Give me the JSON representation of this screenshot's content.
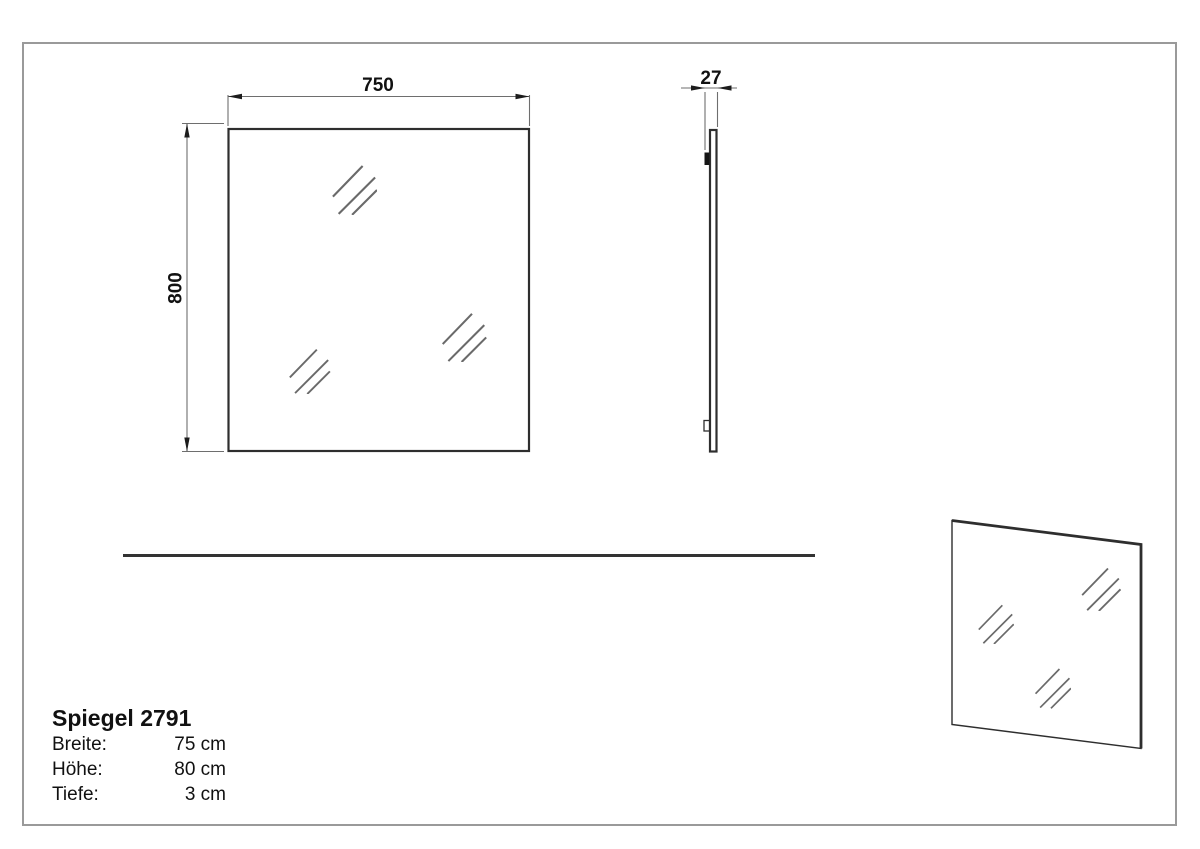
{
  "product": {
    "title": "Spiegel 2791",
    "specs": [
      {
        "label": "Breite:",
        "value": "75 cm"
      },
      {
        "label": "Höhe:",
        "value": "80 cm"
      },
      {
        "label": "Tiefe:",
        "value": "3 cm"
      }
    ]
  },
  "drawing": {
    "front_view": {
      "width_label": "750",
      "height_label": "800"
    },
    "side_view": {
      "depth_label": "27"
    }
  },
  "icons": {
    "reflection": "mirror-glass-hatch-icon"
  },
  "colors": {
    "line_dark": "#2e2e2e",
    "line_dim": "#6e6e6e",
    "arrow": "#1c1c1c",
    "text": "#111111",
    "border": "#9a9a9a",
    "mark": "#6a6a6a",
    "bg": "#ffffff"
  }
}
